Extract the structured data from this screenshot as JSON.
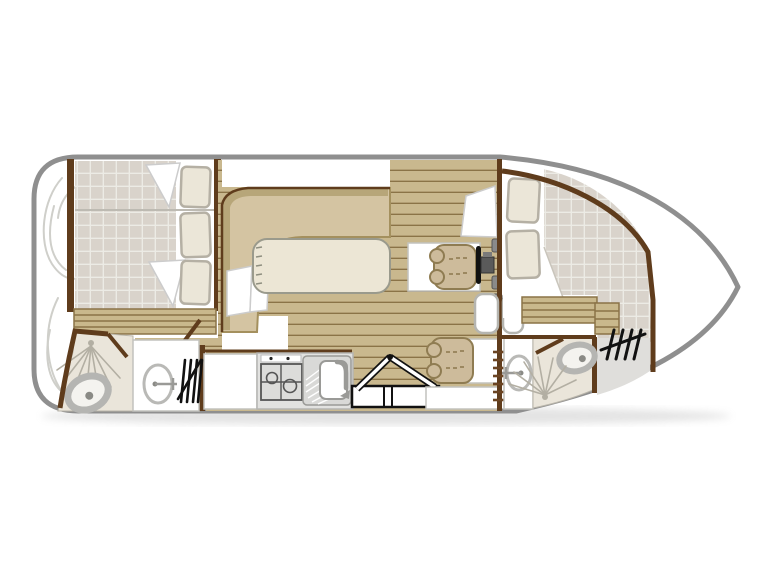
{
  "title": "boat-floor-plan",
  "figure": "top-down canal boat interior floor plan, no text labels",
  "colors": {
    "hull_outline": "#8f8f8f",
    "wall": "#5f3c1c",
    "wood": "#c9b88e",
    "wood_line": "#8a7347",
    "slat": "#c9b88c",
    "mattress": "#d9d3cb",
    "mattress_grid": "#ecebe5",
    "pillow": "#ebe6d8",
    "pillow_edge": "#b5b0a4",
    "bench": "#d4c4a2",
    "bench_edge": "#a4905e",
    "bench_band": "#b7a679",
    "table": "#ece6d5",
    "table_edge": "#9a9a8c",
    "bath_floor": "#eae5da",
    "fixture": "#bbbab4",
    "fixture_dark": "#8a8a85",
    "seat": "#cdbb9b",
    "seat_edge": "#8f7c52",
    "counter": "#e2e2e0",
    "steel": "#d9d9d7",
    "deck_gray": "#dfdedb",
    "icon_black": "#1a1a1a",
    "curl": "#cfcfca"
  },
  "icons": [
    "hull-outline",
    "bow-rope-curls",
    "front-cabin-mattress",
    "pillow",
    "blanket-corner",
    "bed-divider",
    "steps-slats",
    "shower-spray-icon",
    "toilet-icon",
    "washbasin-icon",
    "deck-ladder-icon",
    "cabin-door-leaf",
    "dinette-bench",
    "dinette-table",
    "fridge-cabinet",
    "stove-icon",
    "sink-drainer-icon",
    "folding-steps-icon",
    "helm-seat",
    "steering-wheel-icon",
    "throttle-controls",
    "companionway-doors",
    "aft-cabin-mattress",
    "rear-deck",
    "bulkhead-ladder"
  ]
}
